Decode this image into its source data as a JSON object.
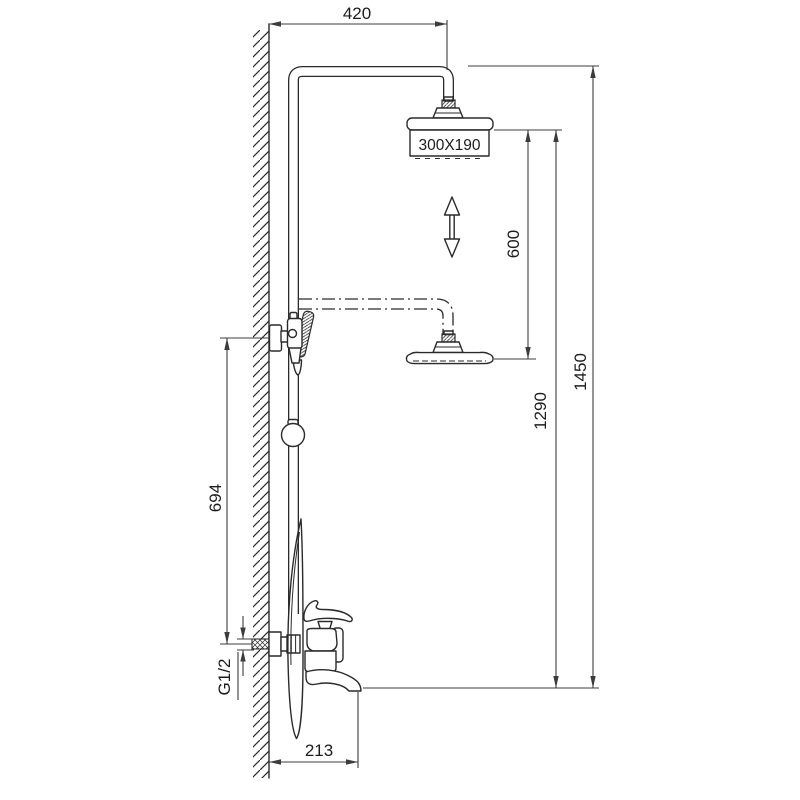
{
  "drawing": {
    "kind": "shower-column-installation-diagram",
    "colors": {
      "line": "#2a2a2a",
      "dim_line": "#3c3c3c",
      "background": "#ffffff"
    },
    "symbols": {
      "height_adjust": "double-arrow-vertical"
    },
    "dims": {
      "arm_width": "420",
      "head_size": "300X190",
      "height_adjust": "600",
      "rail_mount_height": "694",
      "lower_head_height": "1290",
      "total_height": "1450",
      "inlet_thread": "G1/2",
      "spout_reach": "213"
    }
  }
}
